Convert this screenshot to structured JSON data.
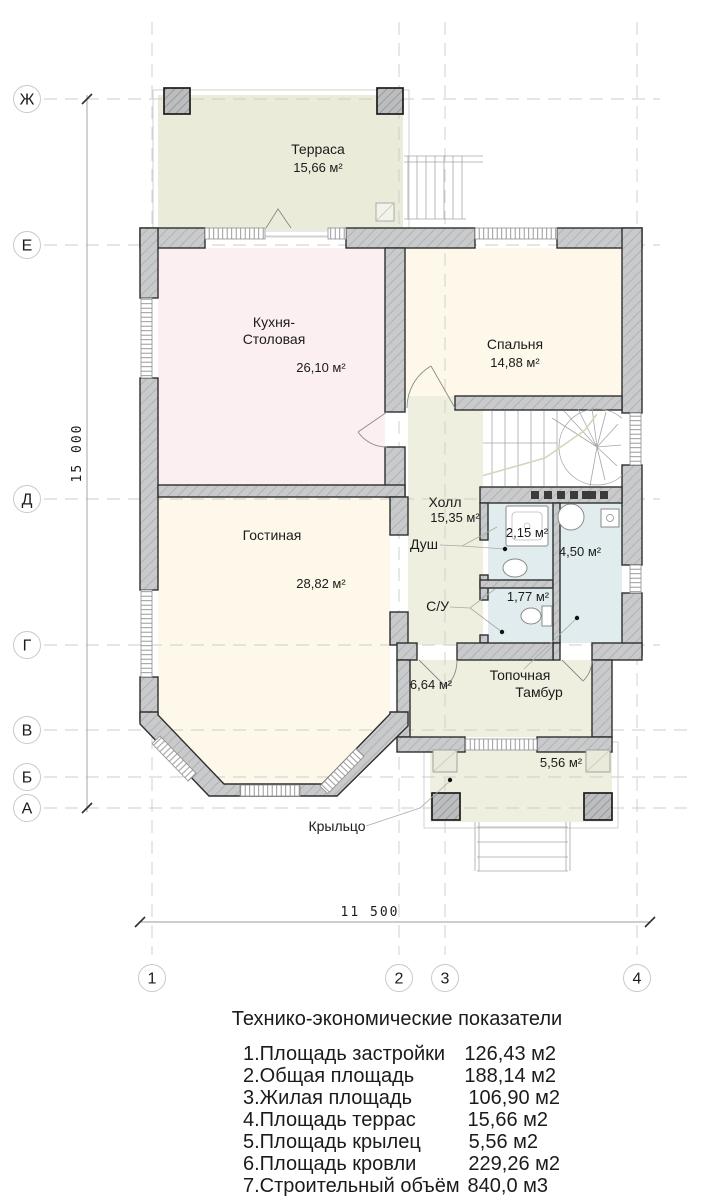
{
  "plan": {
    "axis_rows": [
      "Ж",
      "Е",
      "Д",
      "Г",
      "В",
      "Б",
      "А"
    ],
    "axis_cols": [
      "1",
      "2",
      "3",
      "4"
    ],
    "dims": {
      "vertical": "15 000",
      "horizontal": "11 500"
    },
    "rooms": {
      "terrace": {
        "name": "Терраса",
        "area": "15,66 м²"
      },
      "kitchen": {
        "name_line1": "Кухня-",
        "name_line2": "Столовая",
        "area": "26,10 м²"
      },
      "bedroom": {
        "name": "Спальня",
        "area": "14,88 м²"
      },
      "living": {
        "name": "Гостиная",
        "area": "28,82 м²"
      },
      "hall": {
        "name": "Холл",
        "area": "15,35 м²"
      },
      "shower": {
        "name": "Душ",
        "area": "2,15 м²"
      },
      "wc": {
        "name": "С/У",
        "area": "1,77 м²"
      },
      "boiler": {
        "name": "Топочная",
        "area": "4,50 м²"
      },
      "vestibule": {
        "name": "Тамбур",
        "area": "6,64 м²"
      },
      "porch": {
        "name": "Крыльцо",
        "area": "5,56 м²"
      }
    },
    "colors": {
      "wall": "#c9cacb",
      "outline": "#2f2f2f",
      "terrace": "#eaecd9",
      "kitchen": "#fceff1",
      "cream": "#fdf8e9",
      "hall": "#efefdf",
      "bath": "#e1ecef",
      "stairwell": "#ffffff"
    }
  },
  "table": {
    "title": "Технико-экономические показатели",
    "rows": [
      {
        "label": "1.Площадь застройки",
        "value": "126,43 м2"
      },
      {
        "label": "2.Общая площадь",
        "value": "188,14 м2"
      },
      {
        "label": "3.Жилая площадь",
        "value": "106,90 м2"
      },
      {
        "label": "4.Площадь террас",
        "value": "15,66 м2"
      },
      {
        "label": "5.Площадь крылец",
        "value": "5,56 м2"
      },
      {
        "label": "6.Площадь кровли",
        "value": "229,26 м2"
      },
      {
        "label": "7.Строительный объём",
        "value": "840,0 м3"
      }
    ]
  }
}
